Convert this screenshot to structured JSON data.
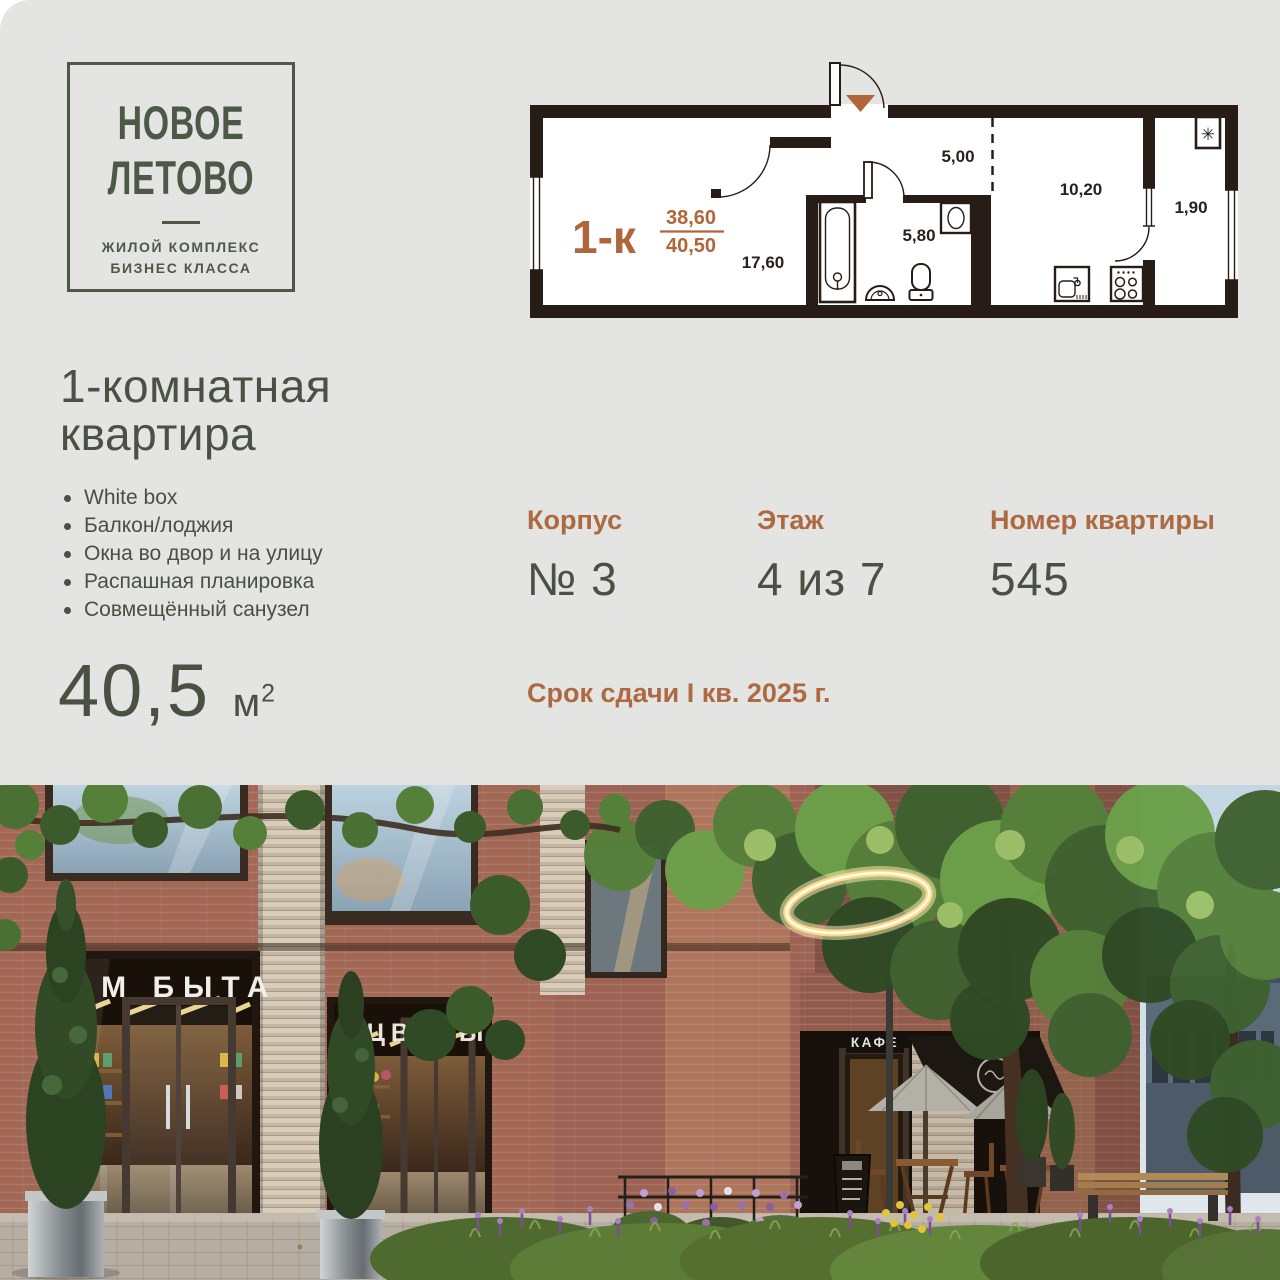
{
  "brand": {
    "name_line1": "НОВОЕ",
    "name_line2": "ЛЕТОВО",
    "tagline_line1": "ЖИЛОЙ КОМПЛЕКС",
    "tagline_line2": "БИЗНЕС КЛАССА"
  },
  "floorplan": {
    "type_label": "1-к",
    "area_living": "38,60",
    "area_total": "40,50",
    "rooms": {
      "room": "17,60",
      "bathroom": "5,80",
      "hall": "5,00",
      "kitchen": "10,20",
      "balcony": "1,90"
    },
    "ac_symbol": "✳"
  },
  "listing": {
    "title_line1": "1-комнатная",
    "title_line2": "квартира",
    "features": [
      "White box",
      "Балкон/лоджия",
      "Окна во двор и на улицу",
      "Распашная планировка",
      "Совмещённый санузел"
    ],
    "area_value": "40,5",
    "area_unit": "м",
    "area_sup": "2",
    "details": [
      {
        "label": "Корпус",
        "value": "№ 3"
      },
      {
        "label": "Этаж",
        "value": "4 из 7"
      },
      {
        "label": "Номер квартиры",
        "value": "545"
      }
    ],
    "deadline": "Срок сдачи I кв. 2025 г."
  },
  "photo": {
    "signs": {
      "store1": "ДОМ БЫТА",
      "store2": "ЦВЕТЫ",
      "cafe": "КАФЕ"
    }
  },
  "colors": {
    "background": "#e4e4e2",
    "text_green": "#4a5143",
    "accent_brown": "#ad6a42",
    "plan_accent": "#b0653a",
    "plan_walls": "#281c16"
  }
}
